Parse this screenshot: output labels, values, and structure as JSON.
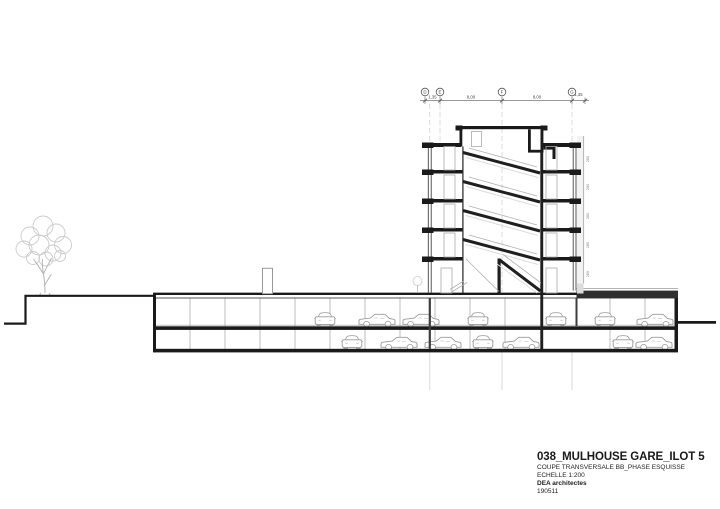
{
  "drawing": {
    "title_block": {
      "project": "038_MULHOUSE GARE_ILOT 5",
      "drawing_name": "COUPE TRANSVERSALE BB_PHASE ESQUISSE",
      "scale": "ECHELLE 1:200",
      "firm": "DEA architectes",
      "date": "190511"
    },
    "top_dimensions": {
      "segments": [
        "1,35",
        "8,00",
        "8,00",
        "1,35"
      ],
      "grid_bubbles": [
        "D",
        "E",
        "F",
        "G"
      ]
    },
    "story_height_labels": [
      "280",
      "280",
      "280",
      "280",
      "280"
    ]
  }
}
